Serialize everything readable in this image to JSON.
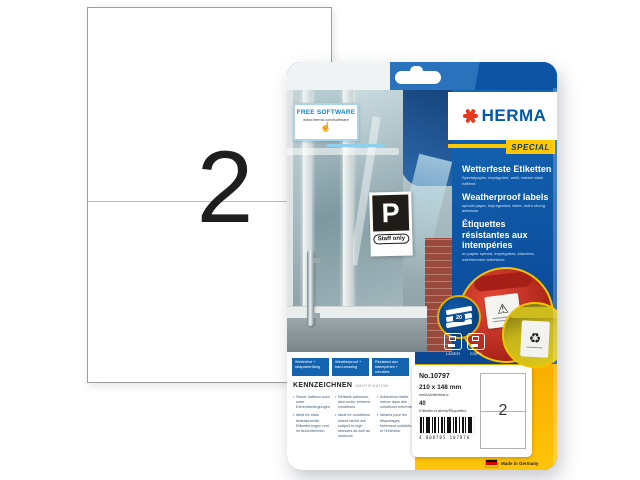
{
  "sheet": {
    "count": "2"
  },
  "package": {
    "free_software_badge": {
      "title": "FREE SOFTWARE",
      "url": "www.herma.com/software"
    },
    "door_sign": {
      "letter": "P",
      "text": "Staff only"
    },
    "brand": {
      "name": "HERMA",
      "edition": "SPECIAL"
    },
    "product_titles": [
      {
        "lang": "de",
        "title": "Wetterfeste Etiketten",
        "subtitle": "Spezialpapier, imprägniert, weiß, extrem stark haftend"
      },
      {
        "lang": "en",
        "title": "Weatherproof labels",
        "subtitle": "special paper, impregnated, white, extra strong adhesion"
      },
      {
        "lang": "fr",
        "title": "Étiquettes résistantes aux intempéries",
        "subtitle": "en papier spécial, imprégnées, blanches, extrêmement adhésives"
      }
    ],
    "sheet_stack_badge": {
      "count": "20"
    },
    "printer_compatibility": [
      {
        "label": "LASER"
      },
      {
        "label": "COPY"
      }
    ],
    "feature_banners": [
      "Wetterfest + strapazierfähig",
      "Weatherproof + hard-wearing",
      "Résistant aux intempéries + robustes"
    ],
    "identification": {
      "heading": "KENNZEICHNEN",
      "subheading": "IDENTIFICATION",
      "columns": [
        {
          "lang": "de",
          "bullets": [
            "Sicher haftend auch unter Extrembedingungen",
            "Ideal für stark beanspruchte Etikettierungen und im Außenbereich"
          ]
        },
        {
          "lang": "en",
          "bullets": [
            "Reliable adhesion, also under extreme conditions",
            "Ideal for conditions where labels are subject to high stresses as well as outdoors"
          ]
        },
        {
          "lang": "fr",
          "bullets": [
            "Adhérence fiable même dans des conditions extrêmes",
            "Idéales pour les étiquetages fortement sollicités et l'extérieur"
          ]
        }
      ]
    },
    "info_panel": {
      "article_no": "No.10797",
      "label_size": "210 x 148 mm",
      "color_variants": "weiß/white/blanc",
      "label_count": "40",
      "label_count_unit": "Etiketten/Labels/Étiquettes",
      "barcode_digits": "4 008705 107976",
      "labels_per_sheet": "2"
    },
    "made_in": {
      "text": "Made in Germany"
    },
    "icons": {
      "warning": "⚠",
      "recycling": "♻",
      "cursor": "☝"
    }
  },
  "colors": {
    "herma_blue": "#0c4f9e",
    "herma_red": "#e8391d",
    "herma_yellow": "#ffc400",
    "panel_blue_light": "#1568b5"
  }
}
